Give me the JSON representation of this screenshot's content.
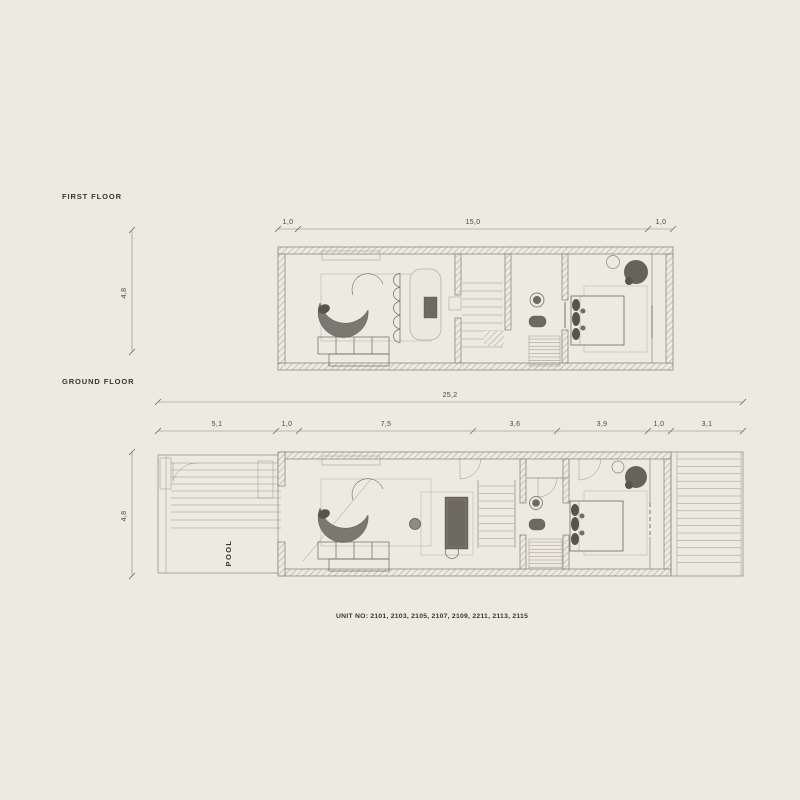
{
  "palette": {
    "background": "#EDEAE0",
    "line": "#8B887C",
    "dark_line": "#5C594F",
    "text": "#3A372E",
    "dim_text": "#4C4940",
    "furniture_fill": "#6D6A61"
  },
  "labels": {
    "first_floor": "FIRST FLOOR",
    "ground_floor": "GROUND FLOOR",
    "pool": "POOL",
    "unit_caption": "UNIT NO: 2101, 2103, 2105, 2107, 2109, 2211, 2113, 2115"
  },
  "first_floor": {
    "dims_top": [
      "1,0",
      "15,0",
      "1,0"
    ],
    "dim_left": "4,8"
  },
  "ground_floor": {
    "dim_overall": "25,2",
    "dims_top": [
      "5,1",
      "1,0",
      "7,5",
      "3,6",
      "3,9",
      "1,0",
      "3,1"
    ],
    "dim_left": "4,8"
  }
}
